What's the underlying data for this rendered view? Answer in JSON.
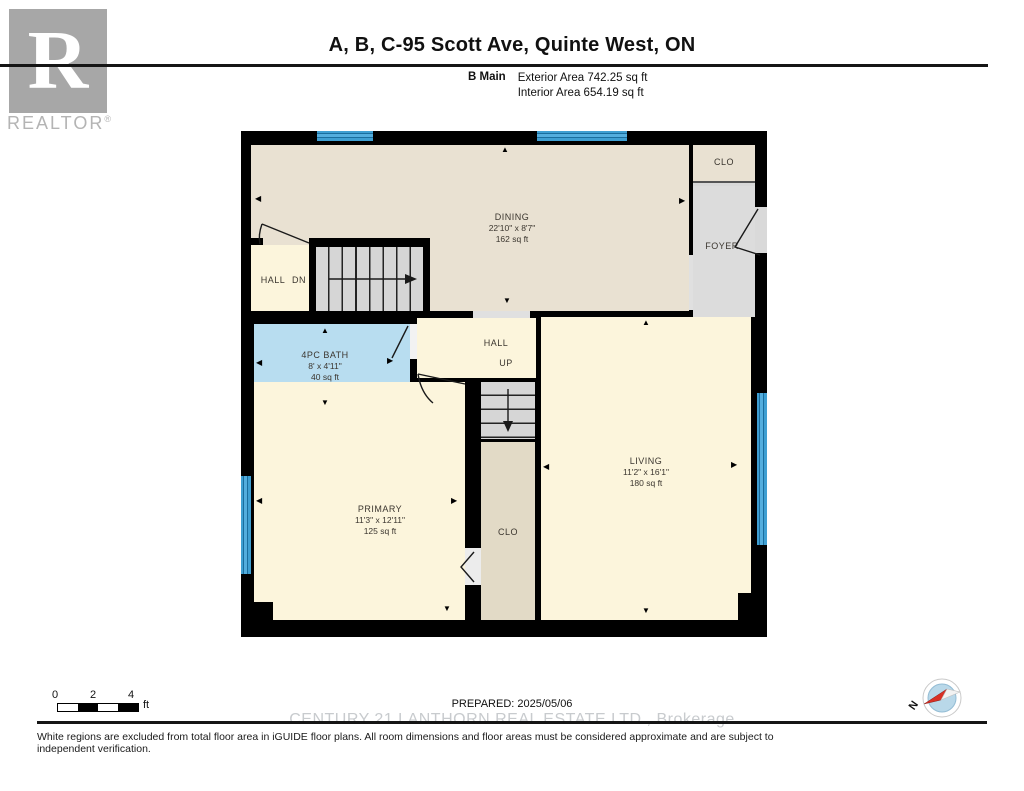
{
  "header": {
    "logo": {
      "r": "R",
      "brand": "REALTOR",
      "reg": "®"
    },
    "title": "A, B, C-95 Scott Ave, Quinte West, ON",
    "floor": {
      "label": "B Main",
      "exterior": "Exterior Area 742.25 sq ft",
      "interior": "Interior Area 654.19 sq ft"
    }
  },
  "plan": {
    "rooms": {
      "dining": {
        "name": "DINING",
        "dims": "22'10\" x 8'7\"",
        "area": "162 sq ft"
      },
      "bath": {
        "name": "4PC BATH",
        "dims": "8' x 4'11\"",
        "area": "40 sq ft"
      },
      "primary": {
        "name": "PRIMARY",
        "dims": "11'3\" x 12'11\"",
        "area": "125 sq ft"
      },
      "living": {
        "name": "LIVING",
        "dims": "11'2\" x 16'1\"",
        "area": "180 sq ft"
      },
      "hall_upper": "HALL",
      "dn": "DN",
      "hall_lower": "HALL",
      "up": "UP",
      "closet_entry": "CLO",
      "closet_primary": "CLO",
      "foyer": "FOYER"
    }
  },
  "glyphs": {
    "up": "▲",
    "down": "▼",
    "left": "◀",
    "right": "▶"
  },
  "footer": {
    "scale": {
      "t0": "0",
      "t1": "2",
      "t2": "4",
      "unit": "ft"
    },
    "prepared": "PREPARED: 2025/05/06",
    "compass_n": "N",
    "watermark": "CENTURY 21 LANTHORN REAL ESTATE LTD., Brokerage",
    "disclaimer": "White regions are excluded from total floor area in iGUIDE floor plans. All room dimensions and floor areas must be considered approximate and are subject to independent verification."
  },
  "colors": {
    "wall": "#000000",
    "dining": "#e9e1d2",
    "cream": "#fcf5dc",
    "bath": "#b8ddf0",
    "foyer_gray": "#dcdcdc",
    "closet_tan": "#e2dac6",
    "window_blue": "#3f9fd2",
    "compass_red": "#d93025",
    "watermark_gray": "#c8cbce"
  }
}
